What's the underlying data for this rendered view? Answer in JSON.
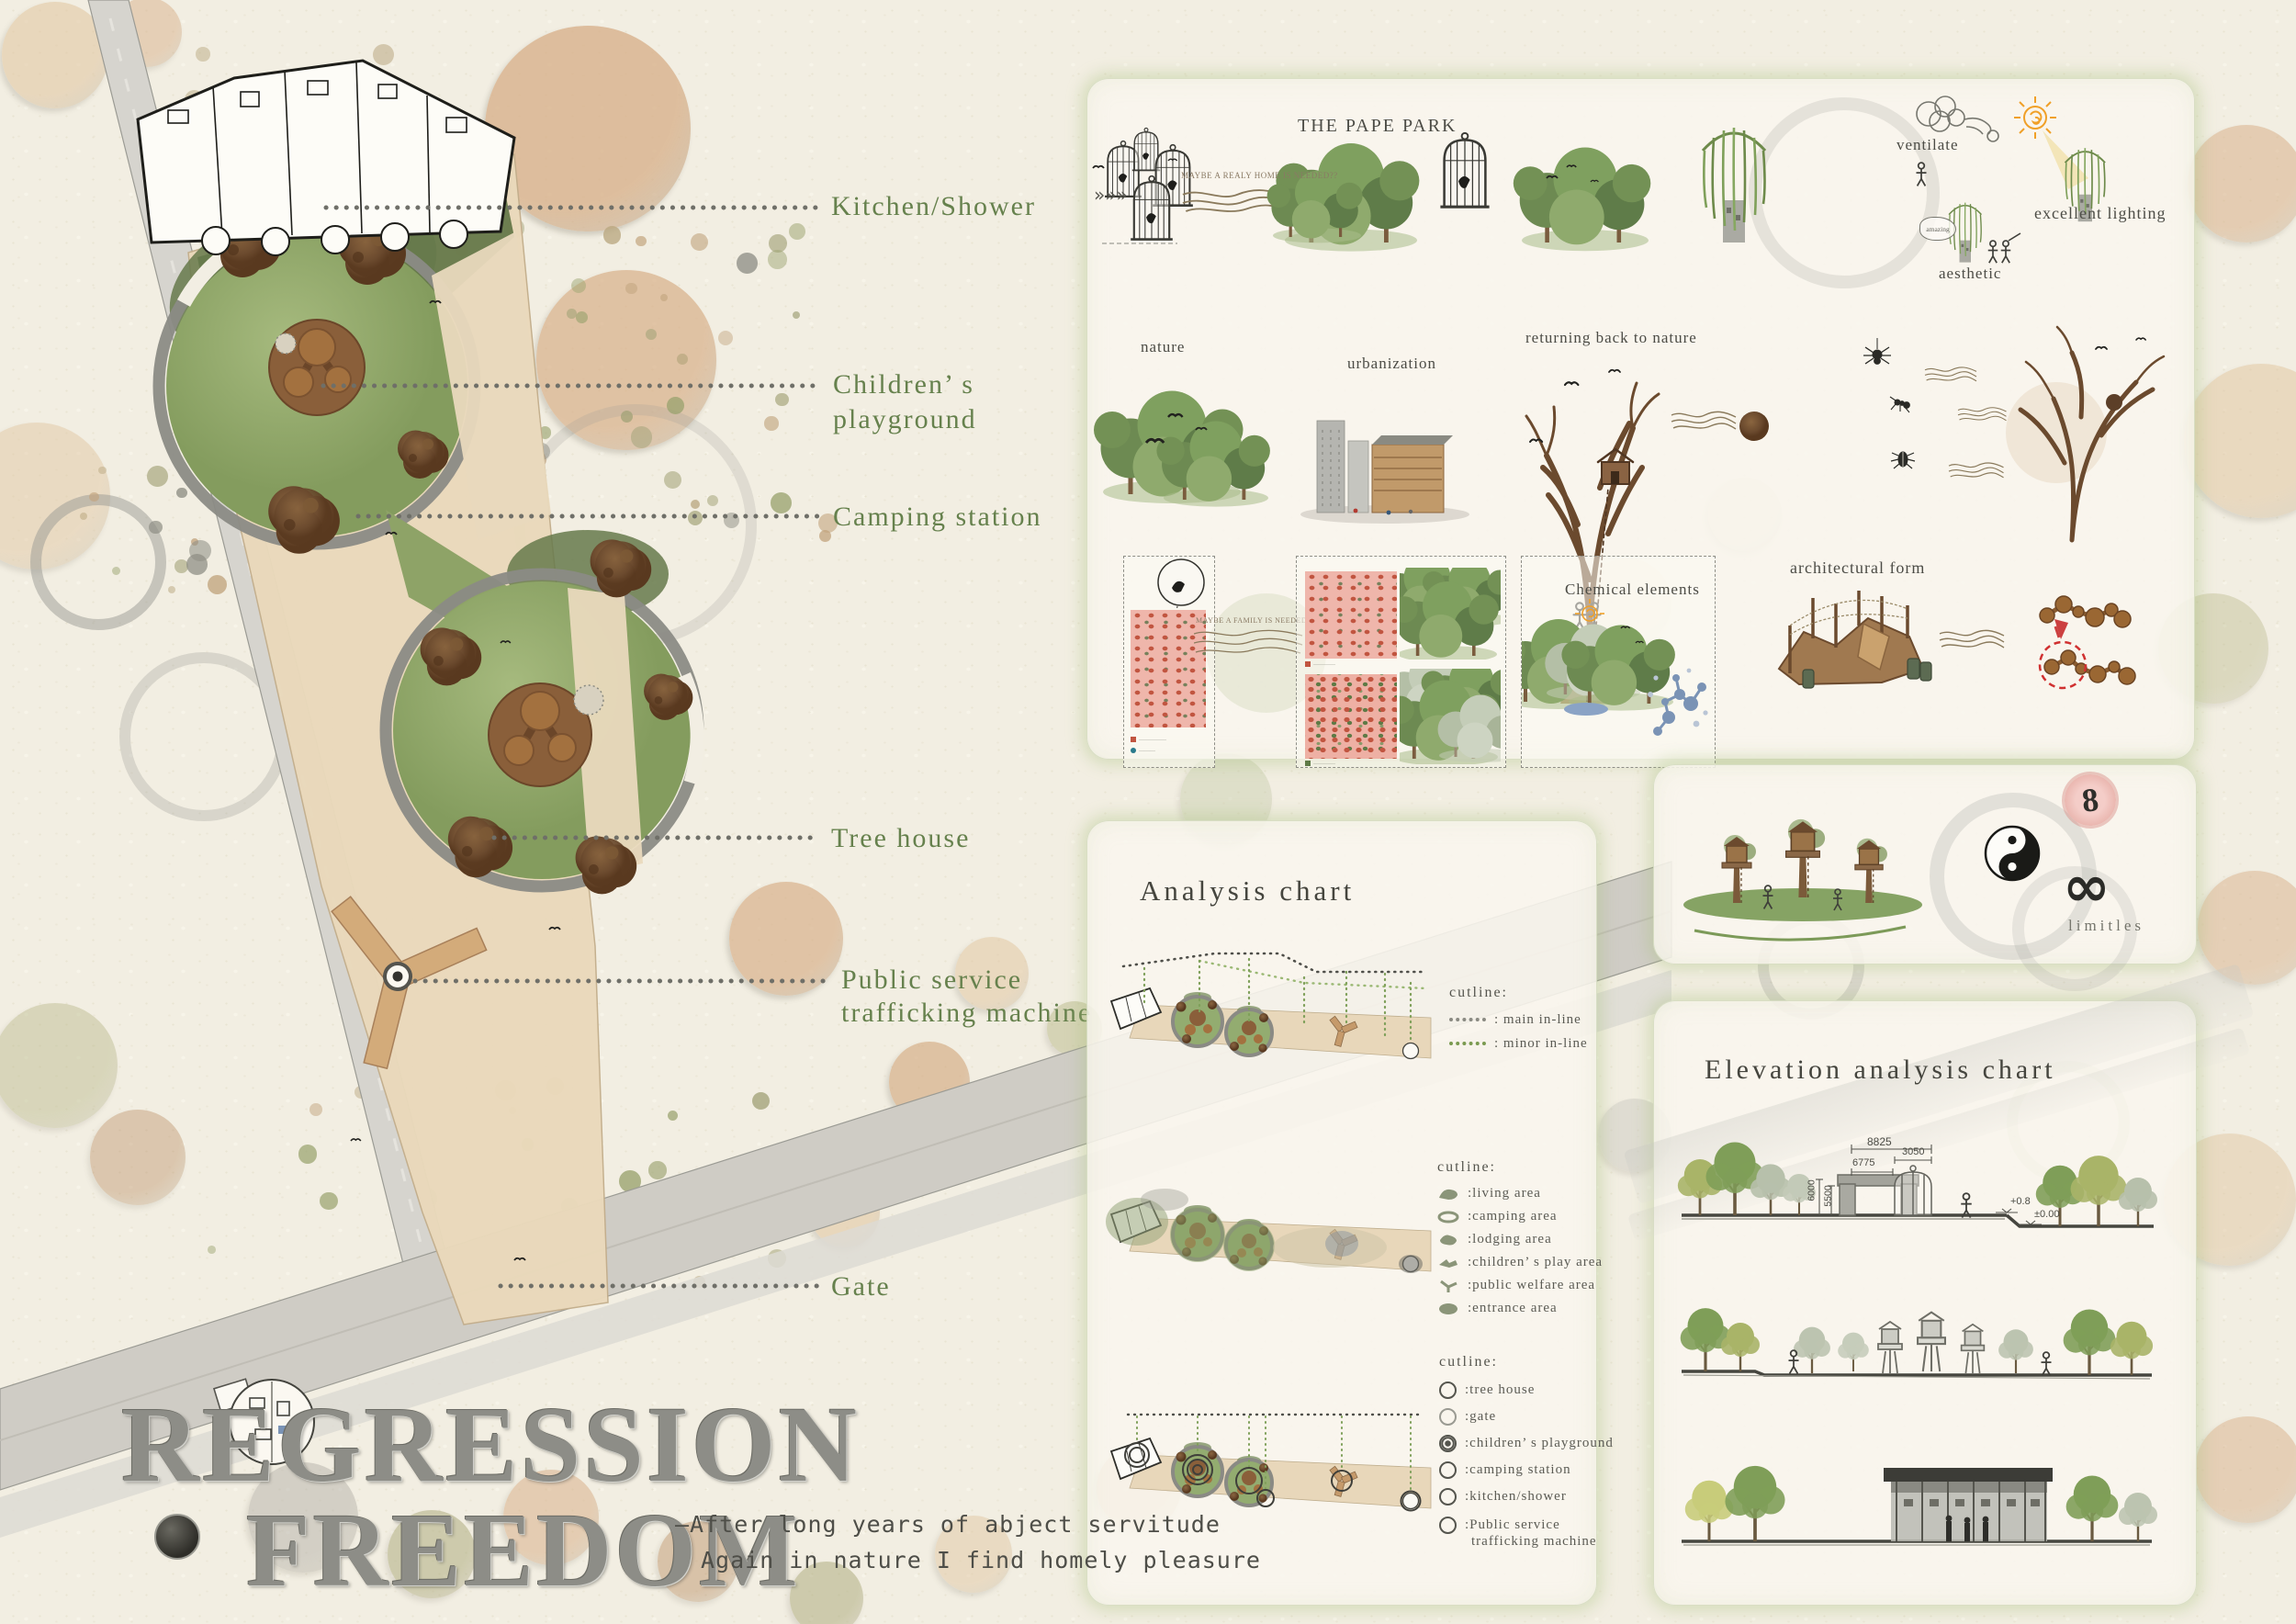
{
  "title_block": {
    "line1": "REGRESSION",
    "line2": "FREEDOM",
    "tagline1": "—After long years of abject servitude",
    "tagline2": "Again in nature I find homely pleasure"
  },
  "plan": {
    "labels": {
      "kitchen_shower": "Kitchen/Shower",
      "childrens_1": "Children’ s",
      "childrens_2": "playground",
      "camping": "Camping station",
      "tree_house": "Tree house",
      "public_service_1": "Public service",
      "public_service_2": "trafficking machine",
      "gate": "Gate"
    }
  },
  "concept": {
    "park_title": "THE PAPE PARK",
    "maybe_note_1": "MAYBE A REALY HOME IS NEEDED??",
    "maybe_note_2": "MAYBE A FAMILY IS NEEDED?",
    "ventilate": "ventilate",
    "excellent_lighting": "excellent lighting",
    "aesthetic": "aesthetic",
    "amazing": "amazing",
    "nature": "nature",
    "urbanization": "urbanization",
    "returning": "returning back to nature",
    "chemical": "Chemical elements",
    "architectural": "architectural form"
  },
  "limitless": {
    "eight": "8",
    "infinity": "∞",
    "label": "limitles"
  },
  "analysis": {
    "title": "Analysis chart",
    "legend_lines": {
      "heading": "cutline:",
      "main": ": main in-line",
      "minor": ": minor in-line"
    },
    "legend_areas": {
      "heading": "cutline:",
      "items": [
        ":living area",
        ":camping area",
        ":lodging area",
        ":children’ s play area",
        ":public welfare area",
        ":entrance area"
      ]
    },
    "legend_points": {
      "heading": "cutline:",
      "items": [
        ":tree house",
        ":gate",
        ":children’ s playground",
        ":camping station",
        ":kitchen/shower"
      ],
      "public_1": ":Public service",
      "public_2": "trafficking machine"
    }
  },
  "elevation": {
    "title": "Elevation analysis chart",
    "dims": {
      "w_total": "8825",
      "w_cage": "3050",
      "w_gate": "6775",
      "h_1": "6000",
      "h_2": "5500",
      "lvl_1": "+0.8",
      "lvl_2": "±0.00"
    }
  }
}
